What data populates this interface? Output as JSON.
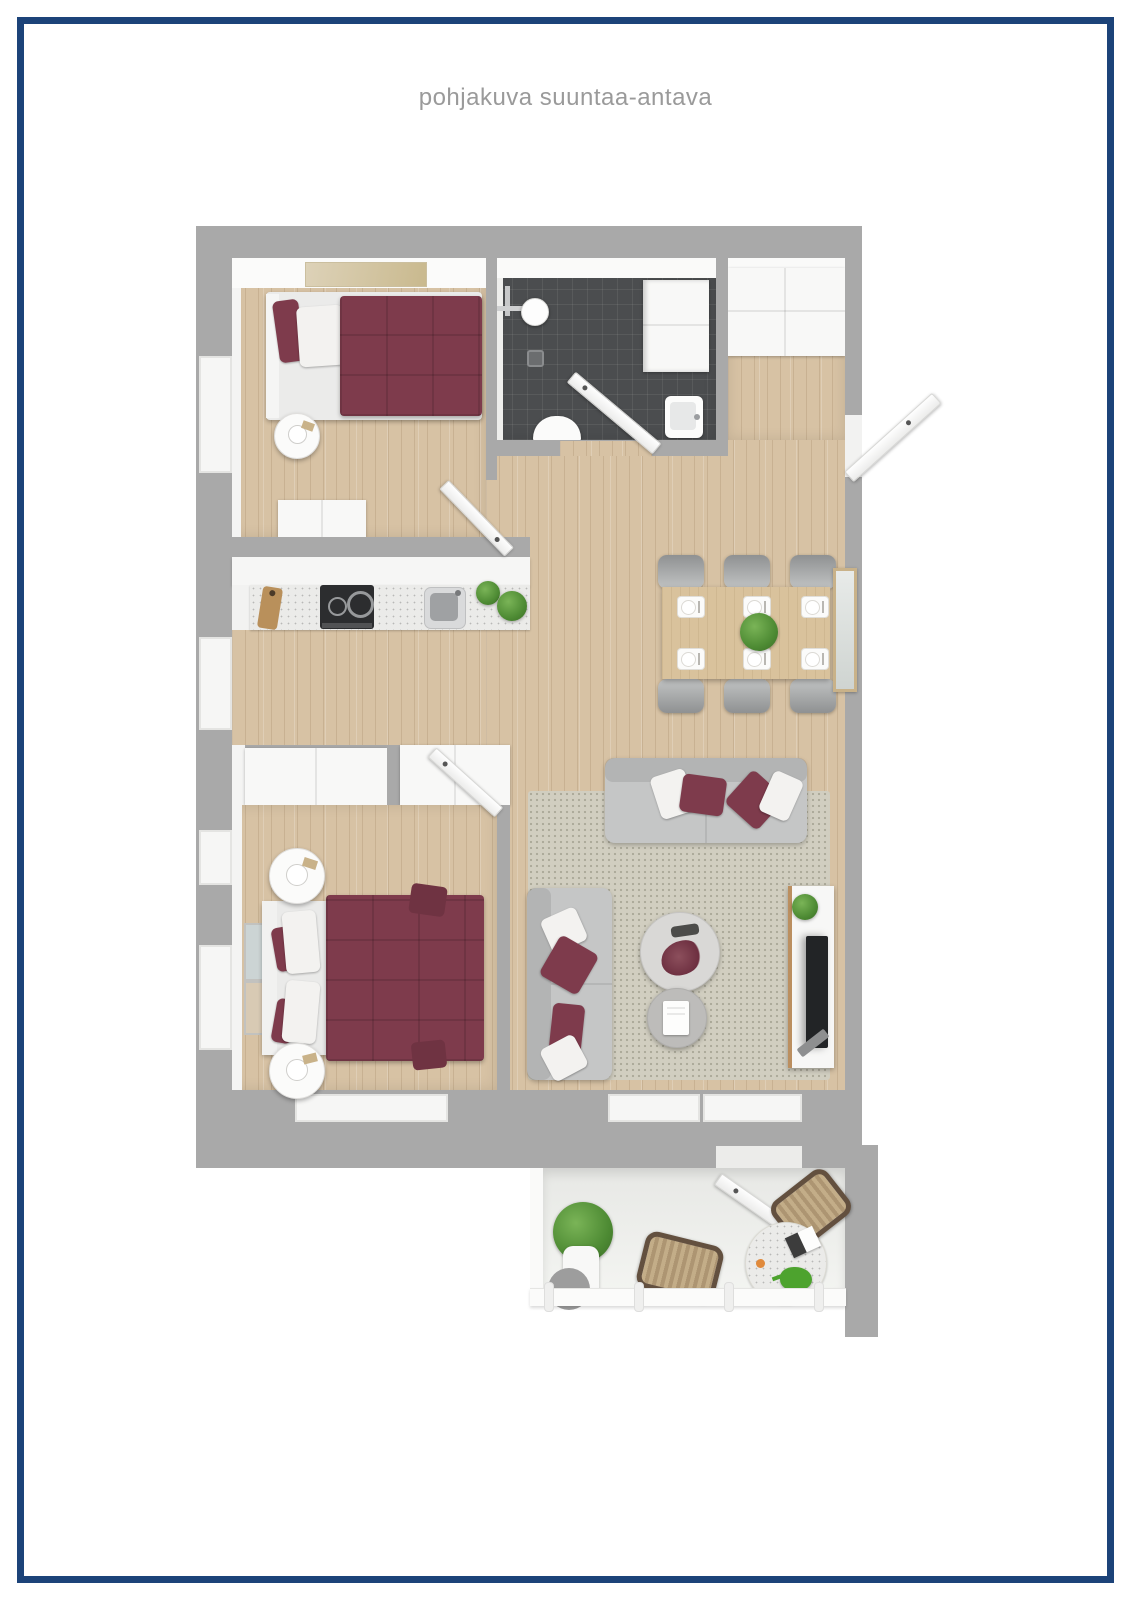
{
  "title": "pohjakuva suuntaa-antava",
  "palette": {
    "frame_navy": "#1c4379",
    "wall_gray": "#a9a9a9",
    "wood_floor": "#d7c2a4",
    "bathroom_tile": "#4b4d4f",
    "accent_burgundy": "#7e3b4c",
    "sofa_gray": "#c5c6c6",
    "rug_beige": "#d1cec0",
    "dining_table_wood": "#d9c29c",
    "plant_green": "#4d8a33",
    "rattan_tan": "#bfa985",
    "counter_white": "#ebebe9",
    "title_gray": "#9a9a9a"
  }
}
